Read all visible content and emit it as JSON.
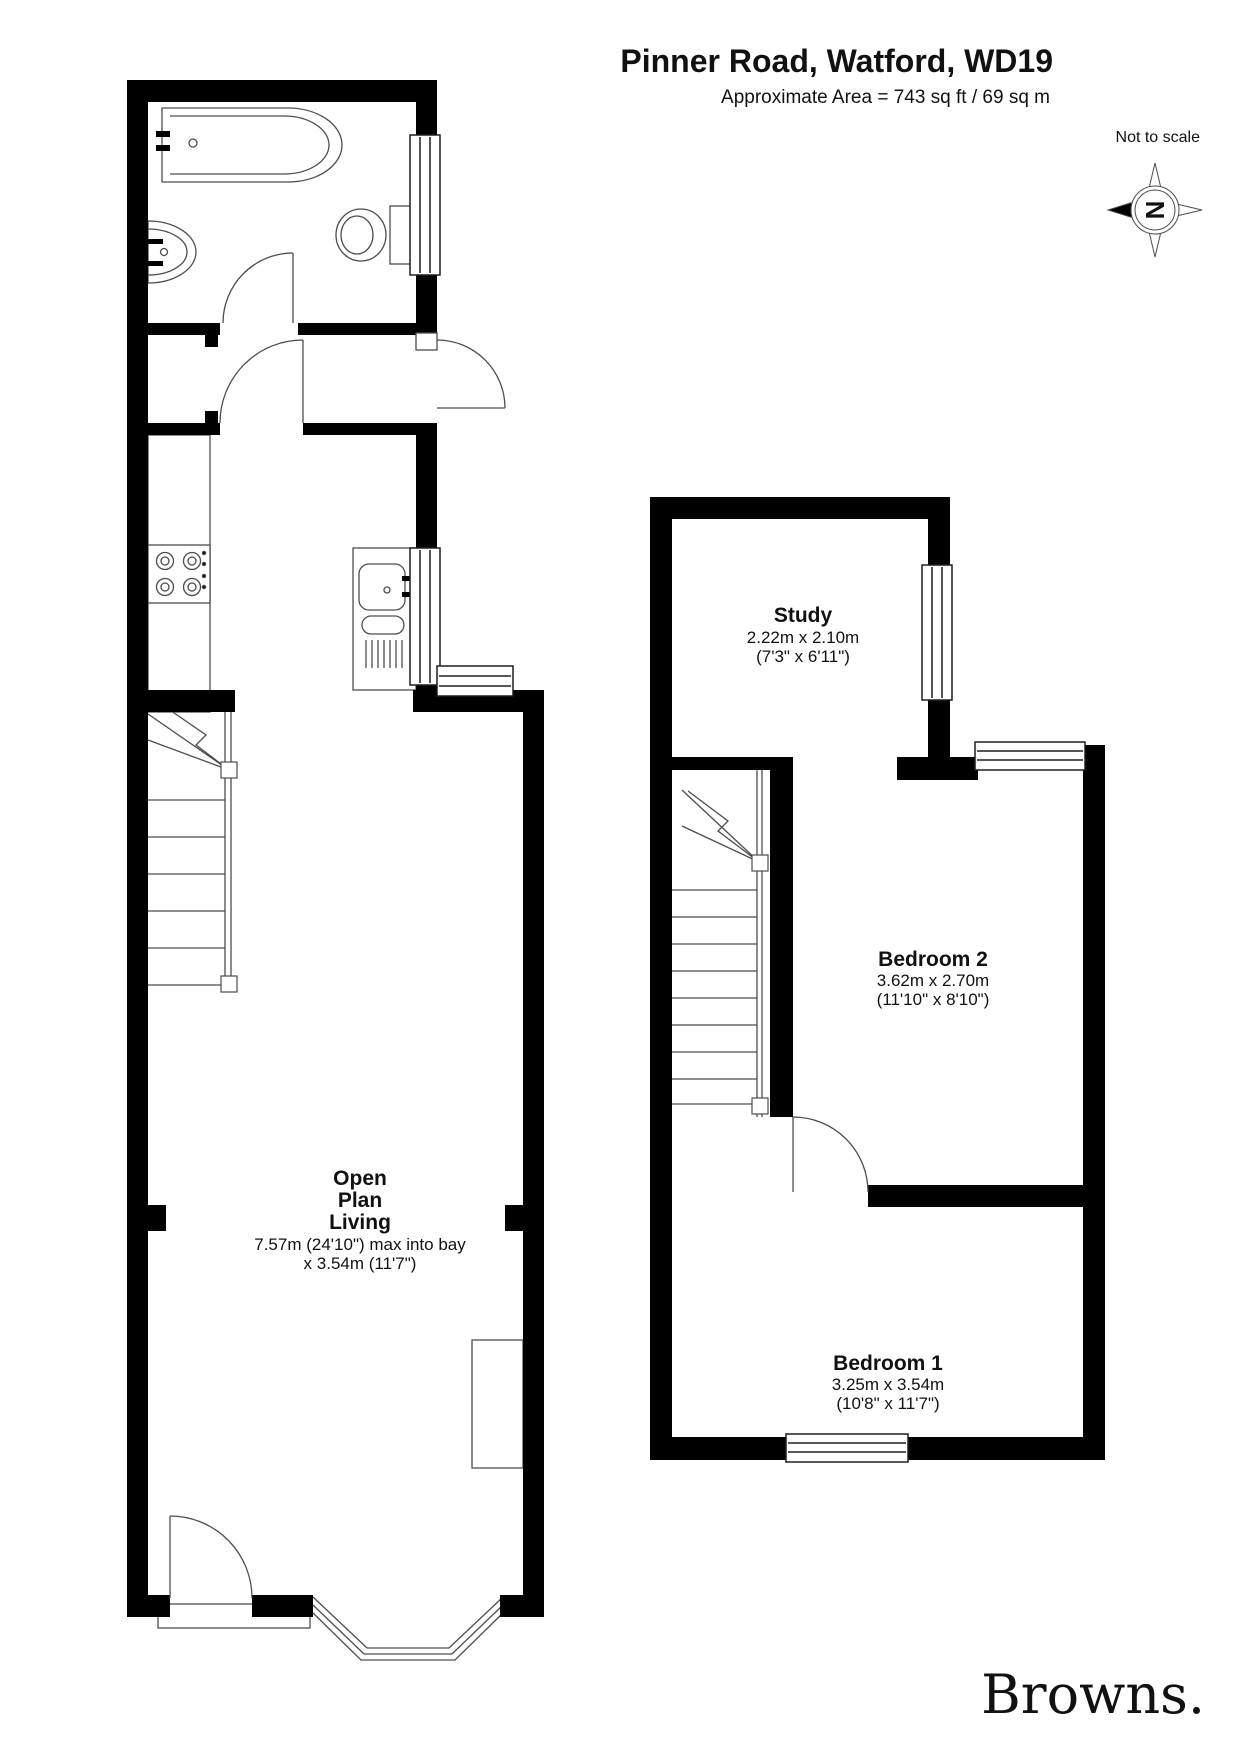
{
  "header": {
    "title": "Pinner Road, Watford, WD19",
    "area_line": "Approximate Area = 743 sq ft / 69 sq m",
    "scale_note": "Not to scale"
  },
  "compass": {
    "letter": "N"
  },
  "rooms": {
    "open_plan_living": {
      "name_line1": "Open",
      "name_line2": "Plan",
      "name_line3": "Living",
      "dim_line1": "7.57m (24'10\") max into bay",
      "dim_line2": "x 3.54m (11'7\")"
    },
    "study": {
      "name": "Study",
      "dim_metric": "2.22m x 2.10m",
      "dim_imperial": "(7'3\" x 6'11\")"
    },
    "bedroom2": {
      "name": "Bedroom 2",
      "dim_metric": "3.62m x 2.70m",
      "dim_imperial": "(11'10\" x 8'10\")"
    },
    "bedroom1": {
      "name": "Bedroom 1",
      "dim_metric": "3.25m x 3.54m",
      "dim_imperial": "(10'8\" x 11'7\")"
    }
  },
  "branding": {
    "logo_text": "Browns."
  },
  "colors": {
    "walls": "#000000",
    "lines": "#4d4d4d",
    "window_frame": "#1f1f1f",
    "logo": "#b49b78"
  }
}
